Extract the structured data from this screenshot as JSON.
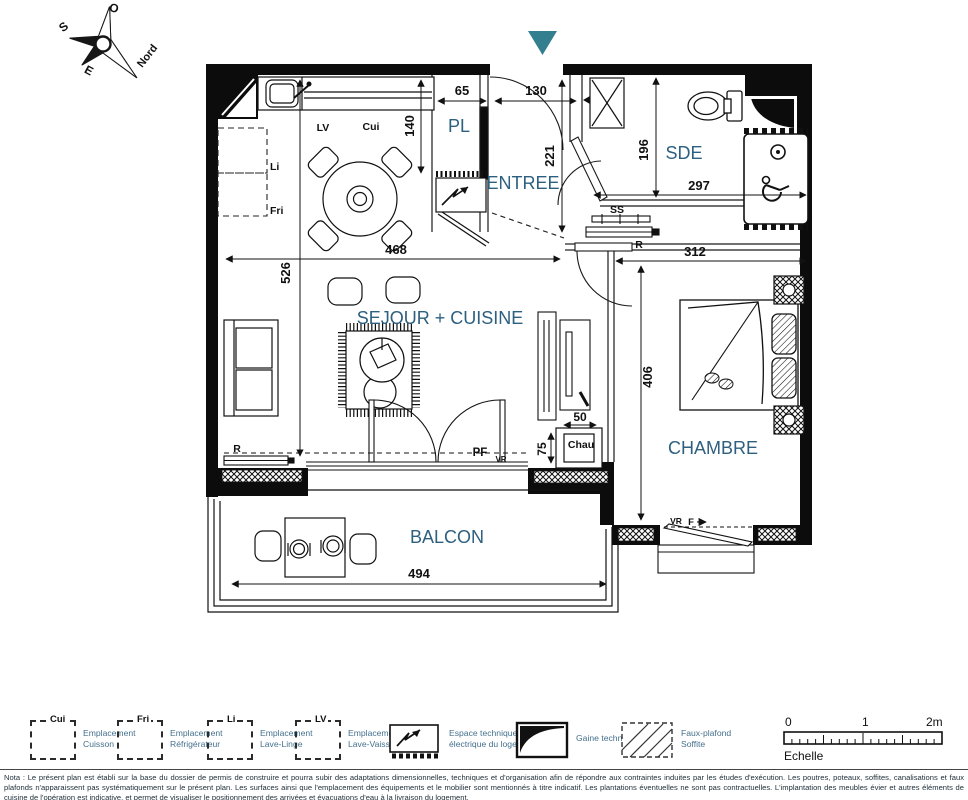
{
  "colors": {
    "accent_teal": "#337f8f",
    "room_label_blue": "#2d5f7f",
    "legend_text_blue": "#44708c",
    "line_black": "#111111"
  },
  "compass": {
    "o": "O",
    "s": "S",
    "e": "E",
    "nord": "Nord"
  },
  "rooms": {
    "pl": "PL",
    "entree": "ENTREE",
    "sde": "SDE",
    "sejour": "SEJOUR + CUISINE",
    "chambre": "CHAMBRE",
    "balcon": "BALCON"
  },
  "dims": {
    "d65": "65",
    "d130": "130",
    "d140": "140",
    "d221": "221",
    "d196": "196",
    "d297": "297",
    "d312": "312",
    "d468": "468",
    "d526": "526",
    "d406": "406",
    "d50": "50",
    "d75": "75",
    "d494": "494"
  },
  "labels": {
    "lv": "LV",
    "cui": "Cui",
    "li": "Li",
    "fri": "Fri",
    "ss": "SS",
    "r_sde": "R",
    "r_sejour": "R",
    "pf": "PF",
    "vr_sejour": "VR",
    "vr_chambre": "VR",
    "f": "F",
    "chau": "Chau"
  },
  "legend": {
    "items": [
      {
        "code": "Cui",
        "line1": "Emplacement",
        "line2": "Cuisson"
      },
      {
        "code": "Fri",
        "line1": "Emplacement",
        "line2": "Réfrigérateur"
      },
      {
        "code": "Li",
        "line1": "Emplacement",
        "line2": "Lave-Linge"
      },
      {
        "code": "LV",
        "line1": "Emplacement",
        "line2": "Lave-Vaisselle"
      }
    ],
    "espace_line1": "Espace technique",
    "espace_line2": "électrique du logement",
    "gaine": "Gaine technique",
    "faux_line1": "Faux-plafond",
    "faux_line2": "Soffite"
  },
  "scalebar": {
    "t0": "0",
    "t1": "1",
    "t2": "2m",
    "label": "Echelle"
  },
  "nota": "Nota : Le présent plan est établi sur la base du dossier de permis de construire et pourra subir des adaptations dimensionnelles, techniques et d'organisation afin de répondre aux contraintes induites par les études d'exécution. Les poutres, poteaux, soffites, canalisations et faux plafonds n'apparaissent pas systématiquement sur le présent plan. Les surfaces ainsi que l'emplacement des équipements et le mobilier sont mentionnés à titre indicatif. Les plantations éventuelles ne sont pas contractuelles. L'implantation des meubles évier et autres éléments de cuisine de l'opération est indicative, et permet de visualiser le positionnement des arrivées et évacuations d'eau à la livraison du logement."
}
